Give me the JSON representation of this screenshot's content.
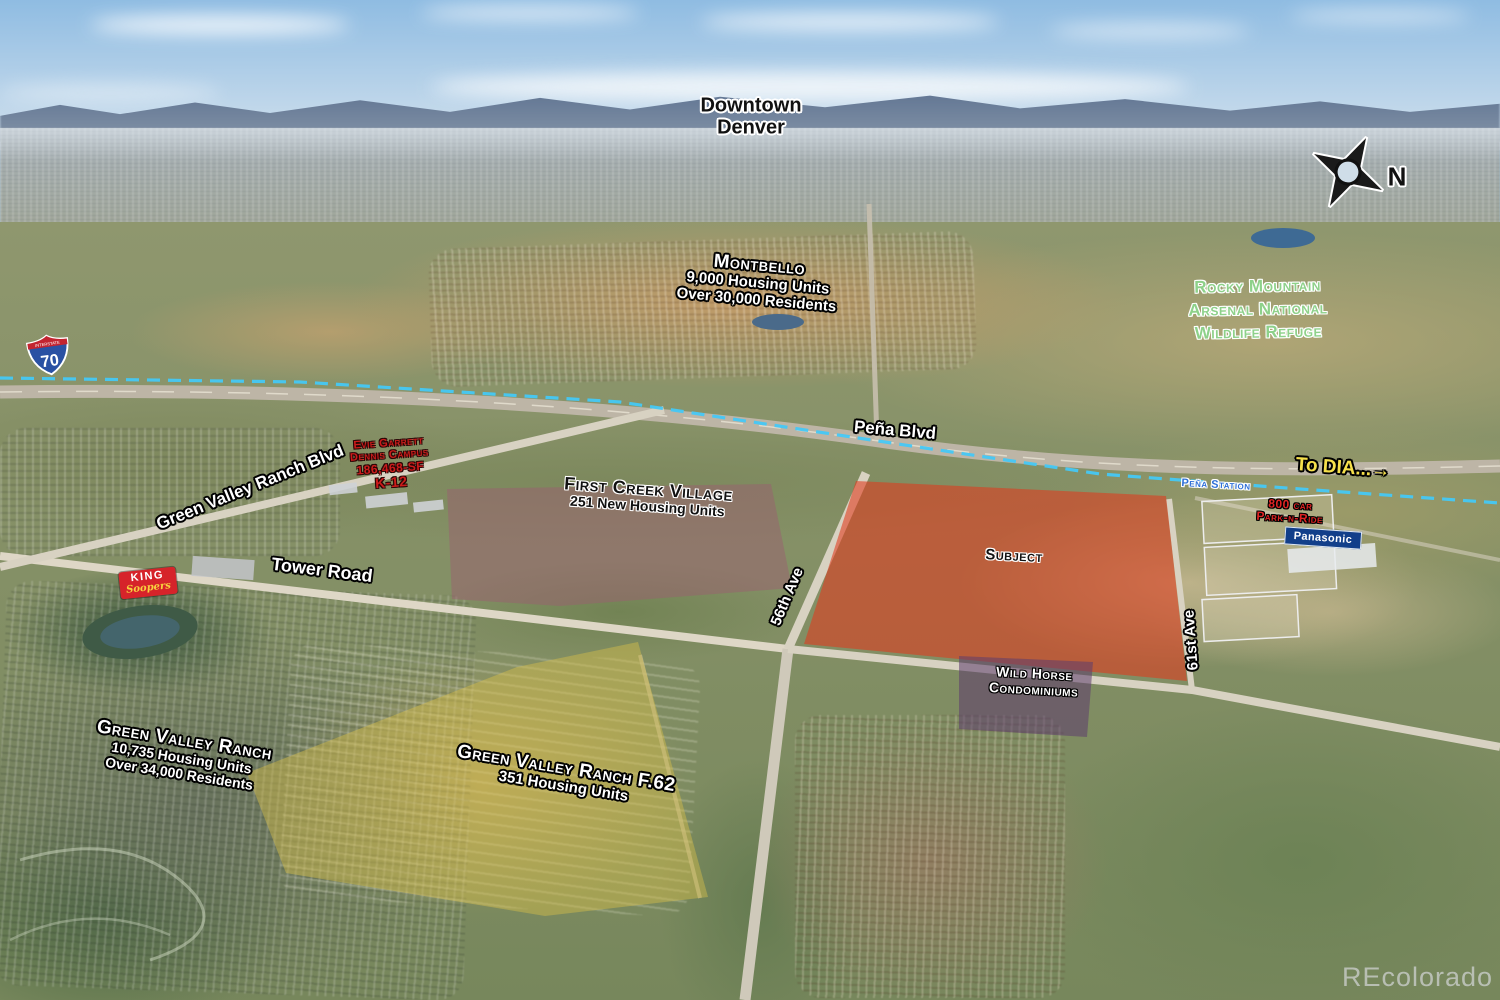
{
  "watermark": "REcolorado",
  "colors": {
    "subject_fill": "#e03a1e",
    "first_creek_fill": "#9a5f70",
    "gvr_f62_fill": "#d8be4a",
    "wild_horse_fill": "#5c3c6e",
    "rail_line": "#45c8f5",
    "arsenal_text": "#8ed18a",
    "to_dia_text": "#f6e04b",
    "school_text": "#cc1b1b",
    "park_n_ride_text": "#e02424",
    "pena_station_text": "#2e6fd8",
    "king_soopers_red": "#d6232a",
    "king_soopers_yellow": "#f7d23e",
    "panasonic_blue": "#123f8a",
    "i70_shield_blue": "#2a51a3",
    "i70_shield_red": "#c32430"
  },
  "labels": {
    "downtown_denver": {
      "line1": "Downtown",
      "line2": "Denver"
    },
    "montbello": {
      "title": "Montbello",
      "sub1": "9,000 Housing Units",
      "sub2": "Over 30,000 Residents"
    },
    "arsenal": {
      "line1": "Rocky Mountain",
      "line2": "Arsenal National",
      "line3": "Wildlife Refuge"
    },
    "compass_n": "N",
    "i70": {
      "banner": "INTERSTATE",
      "number": "70"
    },
    "pena_blvd": "Peña Blvd",
    "to_dia": "To DIA...→",
    "gvr_blvd": "Green Valley Ranch Blvd",
    "school": {
      "line1": "Evie Garrett",
      "line2": "Dennis Campus",
      "line3": "186,468-SF",
      "line4": "K-12"
    },
    "first_creek": {
      "title": "First Creek Village",
      "sub": "251 New Housing Units"
    },
    "pena_station": "Peña Station",
    "park_n_ride": {
      "line1": "800 car",
      "line2": "Park-n-Ride"
    },
    "panasonic": "Panasonic",
    "subject": "Subject",
    "tower_road": "Tower Road",
    "ave_56": "56th Ave",
    "ave_61": "61st Ave",
    "king_soopers": {
      "line1": "KING",
      "line2": "Soopers"
    },
    "gvr": {
      "title": "Green Valley Ranch",
      "sub1": "10,735 Housing Units",
      "sub2": "Over 34,000 Residents"
    },
    "gvr_f62": {
      "title": "Green Valley Ranch F.62",
      "sub": "351 Housing Units"
    },
    "wild_horse": {
      "line1": "Wild Horse",
      "line2": "Condominiums"
    }
  }
}
